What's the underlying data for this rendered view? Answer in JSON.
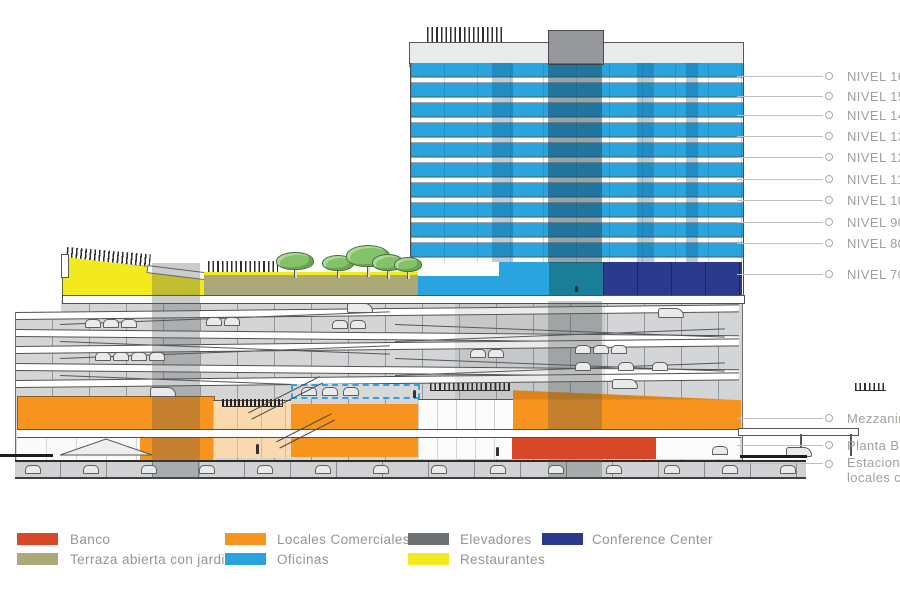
{
  "diagram": {
    "type": "building cross-section",
    "levels_right": [
      "NIVEL 1600",
      "NIVEL 1500",
      "NIVEL 1400",
      "NIVEL 1300",
      "NIVEL 1200",
      "NIVEL 1100",
      "NIVEL 1000",
      "NIVEL 900",
      "NIVEL 800",
      "NIVEL 700"
    ],
    "levels_lower": [
      {
        "label": "Mezzanine"
      },
      {
        "label": "Planta Baja"
      },
      {
        "line1": "Estacionam",
        "line2": "locales com"
      }
    ],
    "legend": {
      "items": [
        {
          "name": "banco",
          "label": "Banco",
          "color": "#D64828"
        },
        {
          "name": "terraza",
          "label": "Terraza abierta con jardines",
          "color": "#ABA978"
        },
        {
          "name": "locales-comerciales",
          "label": "Locales Comerciales",
          "color": "#F7941E"
        },
        {
          "name": "oficinas",
          "label": "Oficinas",
          "color": "#29A4DE"
        },
        {
          "name": "elevadores",
          "label": "Elevadores",
          "color": "#6D7072"
        },
        {
          "name": "restaurantes",
          "label": "Restaurantes",
          "color": "#F2EA1F"
        },
        {
          "name": "conference-center",
          "label": "Conference Center",
          "color": "#2B3A8C"
        }
      ]
    },
    "palette": {
      "core_teal_overlap": "#1B7E99",
      "atrium_peach": "#FAD9AE",
      "parking_gray": "#D3D5D6",
      "label_gray": "#A3A09B"
    }
  }
}
